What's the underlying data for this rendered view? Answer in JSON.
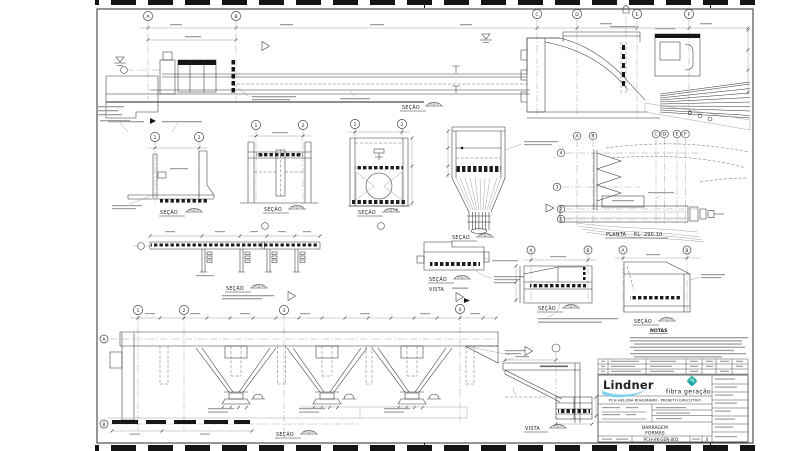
{
  "sheet": {
    "labels": {
      "secao": "SEÇÃO",
      "vista": "VISTA",
      "planta_word": "PLANTA",
      "planta_el": "EL. 290.10",
      "notas": "NOTAS",
      "section_f": "F"
    },
    "grid": {
      "A": "A",
      "B": "B",
      "C": "C",
      "D": "D",
      "E": "E",
      "F": "F",
      "n1": "1",
      "n2": "2",
      "n3": "3",
      "n4": "4"
    }
  },
  "title_block": {
    "logo_lindner": "Lindner",
    "logo_fibra": "fibra geração",
    "project_line": "PCH HELENA KUHLMANN - PROJETO EXECUTIVO",
    "title_line1": "BARRAGEM",
    "title_line2": "FORMAS",
    "drawing_number": "PCH-HK-GEN-001",
    "revision": "0"
  },
  "colors": {
    "line": "#2e2e2e",
    "lindner_navy": "#1d2f9e",
    "lindner_blue": "#7fd2ee",
    "fibra_teal": "#13b1b5"
  }
}
